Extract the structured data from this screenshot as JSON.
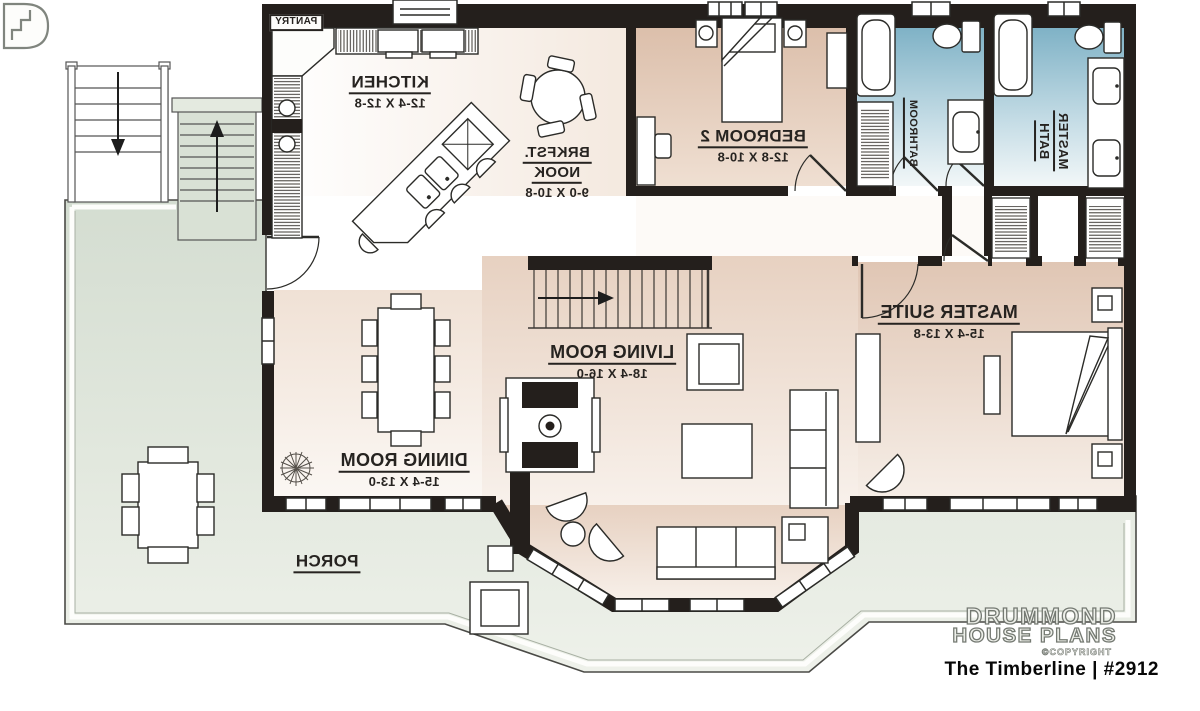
{
  "plan": {
    "rooms": {
      "pantry": {
        "name": "PANTRY"
      },
      "kitchen": {
        "name": "KITCHEN",
        "dims": "12-4 X 12-8"
      },
      "brkfst_nook": {
        "name_line1": "BRKFST.",
        "name_line2": "NOOK",
        "dims": "9-0 X 10-8"
      },
      "bedroom2": {
        "name": "BEDROOM 2",
        "dims": "12-8 X 10-8"
      },
      "bathroom": {
        "name": "BATHROOM"
      },
      "master_bath": {
        "name_line1": "MASTER",
        "name_line2": "BATH"
      },
      "master_suite": {
        "name": "MASTER SUITE",
        "dims": "15-4 X 13-8"
      },
      "living_room": {
        "name": "LIVING ROOM",
        "dims": "18-4 X 16-0"
      },
      "dining_room": {
        "name": "DINING ROOM",
        "dims": "15-4 X 13-0"
      },
      "porch": {
        "name": "PORCH"
      }
    },
    "colors": {
      "wall": "#241f1c",
      "bath_blue": "#7fb2c6",
      "bedroom_beige": "#dcbfab",
      "living_beige": "#e7d1c1",
      "porch_green": "#dbe3d7",
      "floor_white": "#ffffff"
    }
  },
  "watermark": {
    "brand_line1": "DRUMMOND",
    "brand_line2": "HOUSE PLANS",
    "copyright": "©COPYRIGHT",
    "plan_title": "The Timberline | #2912"
  }
}
